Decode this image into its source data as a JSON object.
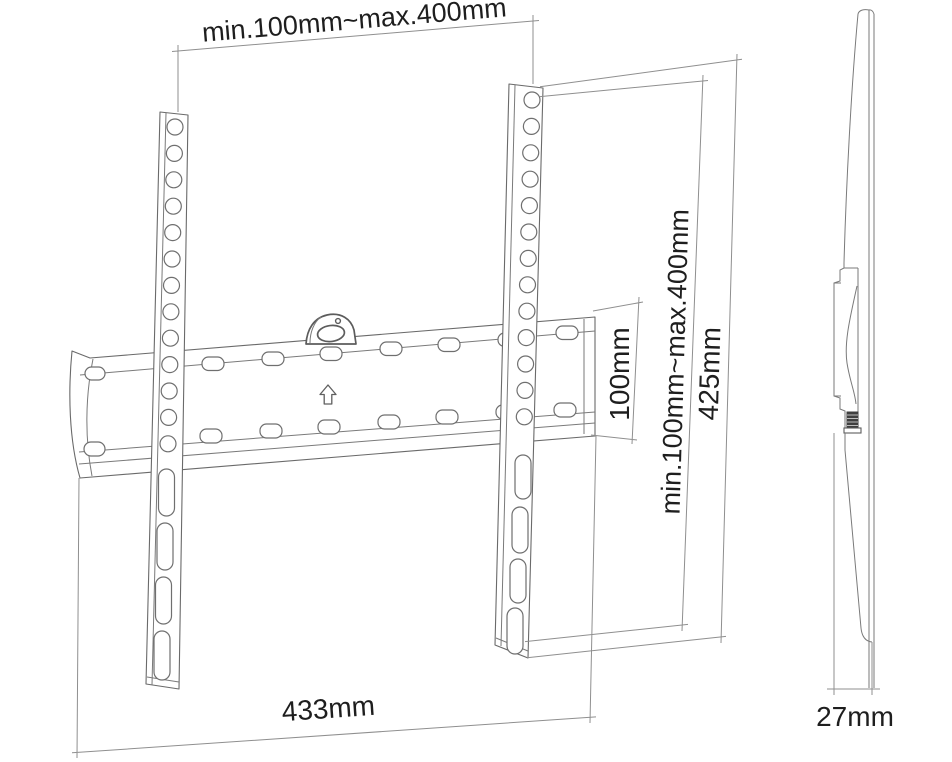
{
  "colors": {
    "background": "#ffffff",
    "part_line": "#6a6a6a",
    "dimension_line": "#8f8f8f",
    "label_text": "#1e1e1e",
    "screw_fill": "#3f3f3f"
  },
  "dimensions": {
    "vesa_width": "min.100mm~max.400mm",
    "vesa_height": "min.100mm~max.400mm",
    "rail_height": "425mm",
    "plate_height": "100mm",
    "plate_width": "433mm",
    "depth": "27mm"
  },
  "symbols": {
    "up_arrow": "up-arrow",
    "level_window": "level-window"
  }
}
